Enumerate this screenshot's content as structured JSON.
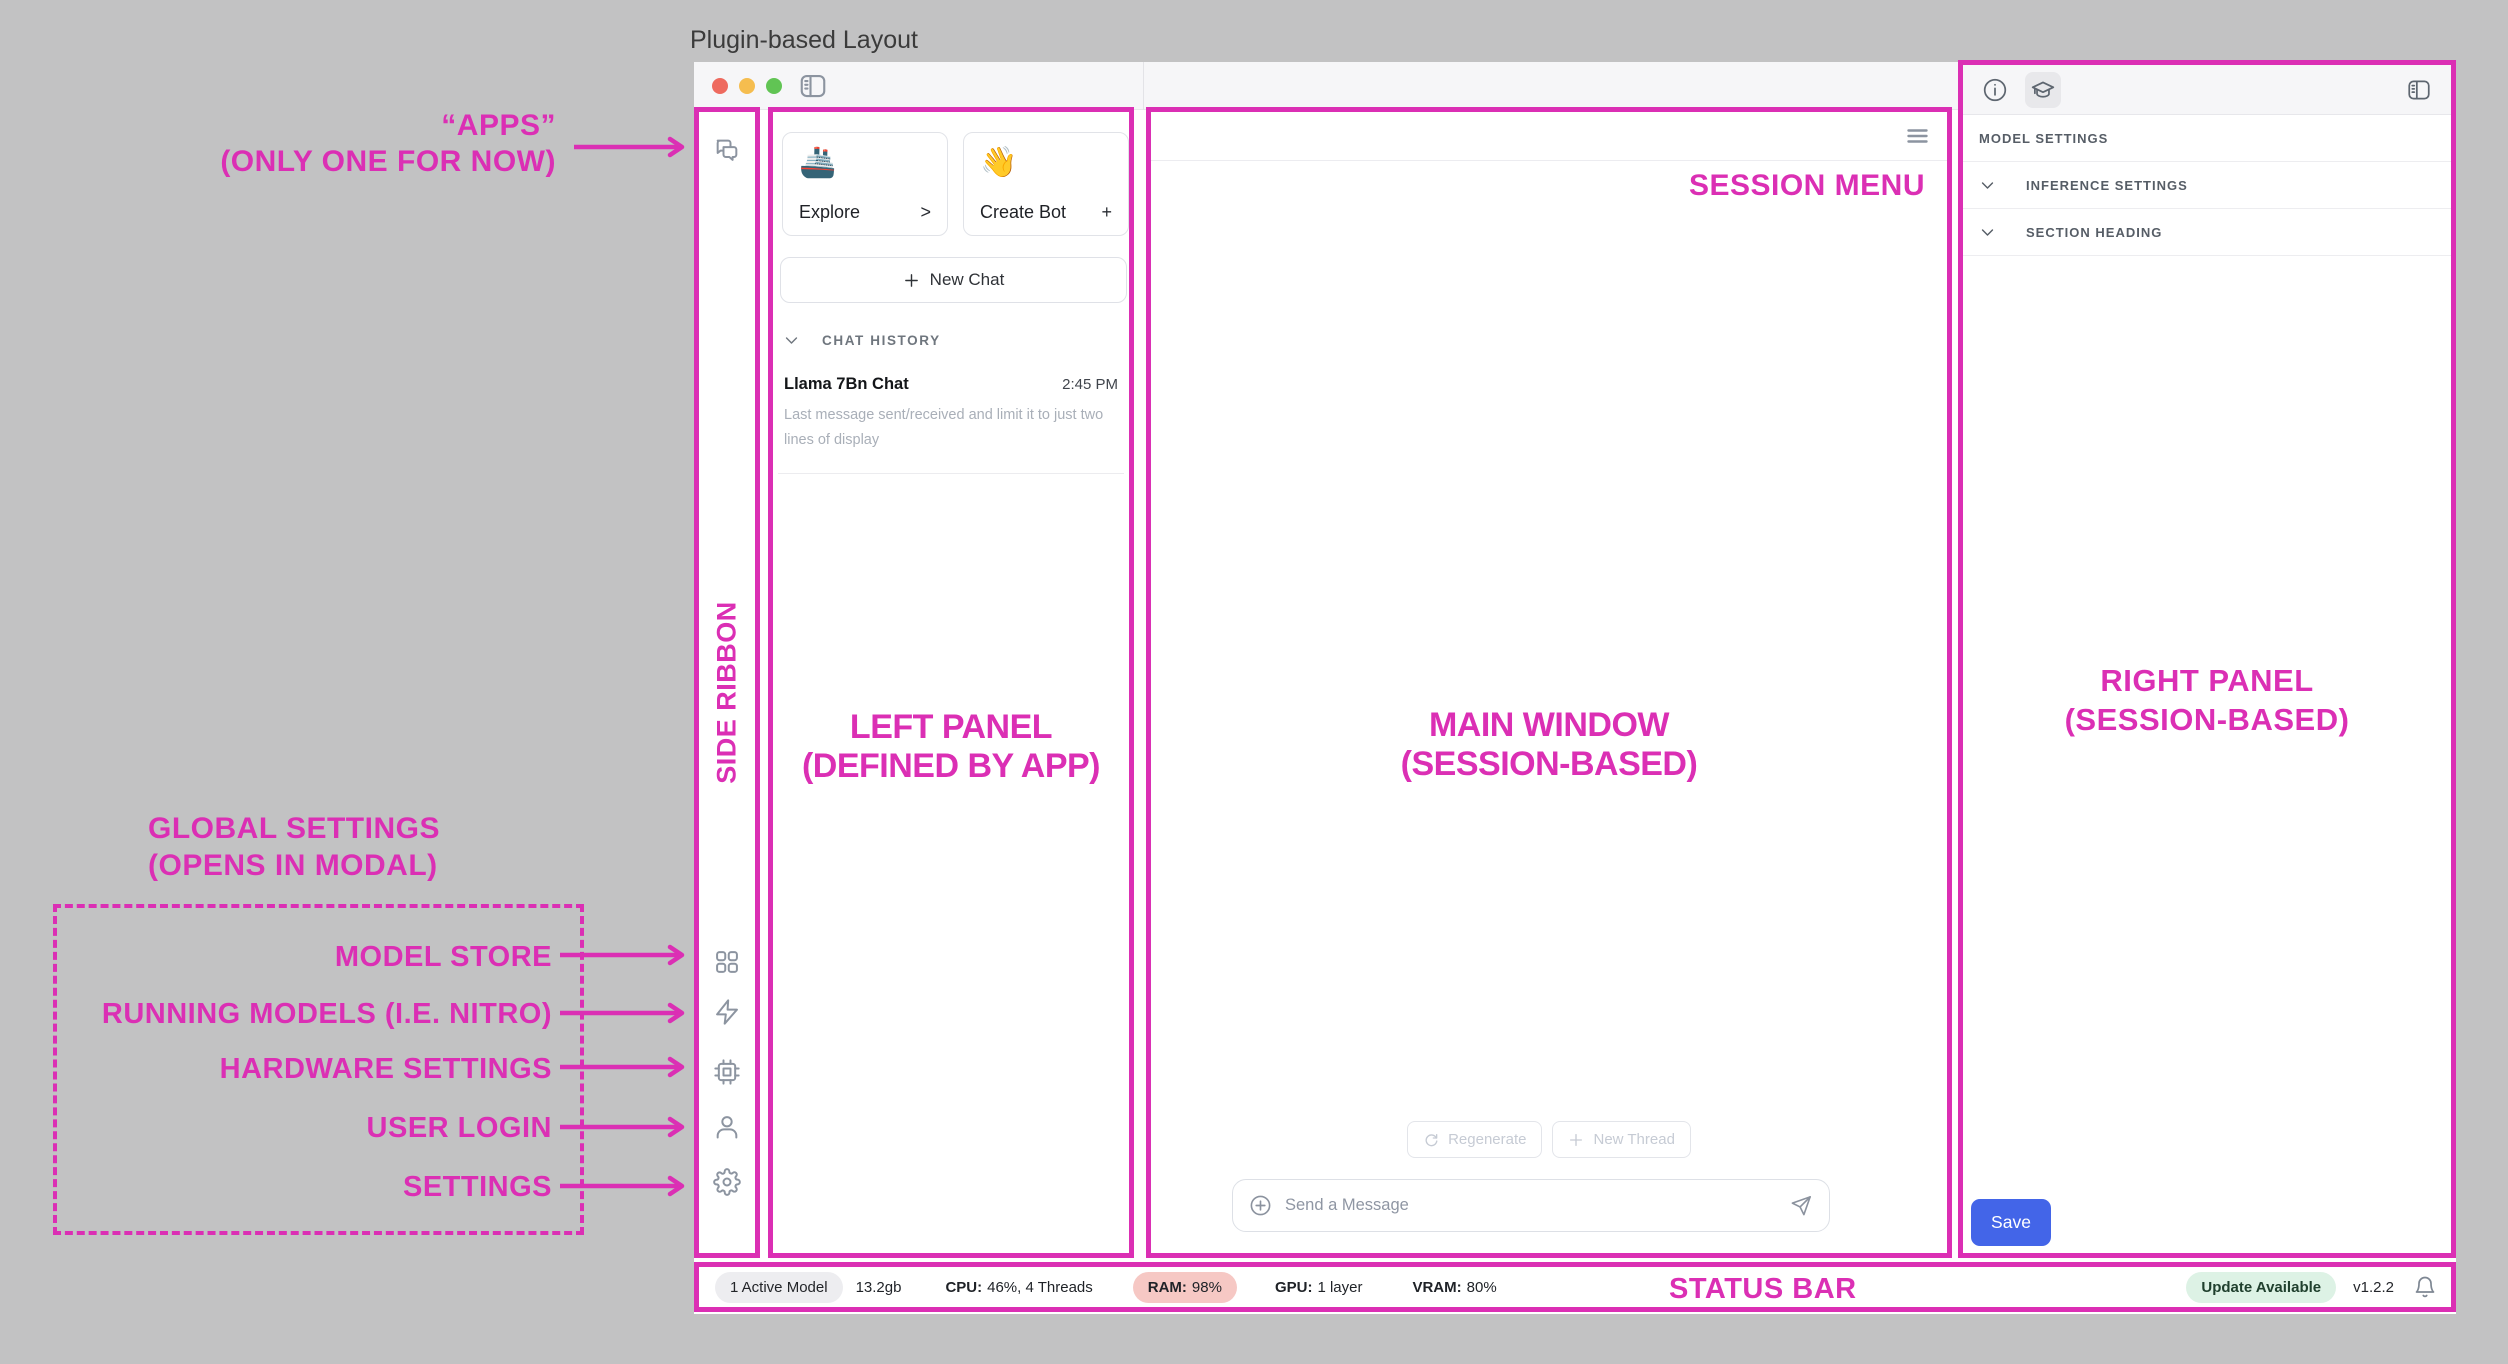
{
  "title": "Plugin-based Layout",
  "annotations": {
    "apps": {
      "line1": "“APPS”",
      "line2": "(ONLY ONE FOR NOW)"
    },
    "side_ribbon": "SIDE RIBBON",
    "left_panel": {
      "line1": "LEFT PANEL",
      "line2": "(DEFINED BY APP)"
    },
    "main_window": {
      "line1": "MAIN WINDOW",
      "line2": "(SESSION-BASED)"
    },
    "session_menu": "SESSION MENU",
    "right_panel": {
      "line1": "RIGHT PANEL",
      "line2": "(SESSION-BASED)"
    },
    "global_settings": {
      "line1": "GLOBAL SETTINGS",
      "line2": "(OPENS IN MODAL)"
    },
    "global_items": [
      "MODEL STORE",
      "RUNNING MODELS (I.E. NITRO)",
      "HARDWARE SETTINGS",
      "USER LOGIN",
      "SETTINGS"
    ],
    "status_bar": "STATUS BAR"
  },
  "left_panel": {
    "explore": {
      "emoji": "🚢",
      "label": "Explore",
      "affix": ">"
    },
    "create_bot": {
      "emoji": "👋",
      "label": "Create Bot",
      "affix": "+"
    },
    "new_chat_label": "New Chat",
    "chat_history_label": "CHAT HISTORY",
    "chat_item": {
      "title": "Llama 7Bn Chat",
      "time": "2:45 PM",
      "preview": "Last message sent/received and limit it to just two lines of display"
    }
  },
  "ribbon": {
    "wave_emoji": "👋"
  },
  "main_window": {
    "regenerate_label": "Regenerate",
    "new_thread_label": "New Thread",
    "message_placeholder": "Send a Message"
  },
  "right_panel": {
    "model_settings_label": "MODEL SETTINGS",
    "sections": [
      "INFERENCE SETTINGS",
      "SECTION HEADING"
    ],
    "save_label": "Save"
  },
  "status_bar": {
    "active_model": "1 Active Model",
    "memory": "13.2gb",
    "cpu_label": "CPU:",
    "cpu_value": "46%, 4 Threads",
    "ram_label": "RAM:",
    "ram_value": "98%",
    "gpu_label": "GPU:",
    "gpu_value": "1 layer",
    "vram_label": "VRAM:",
    "vram_value": "80%",
    "update_badge": "Update Available",
    "version": "v1.2.2"
  }
}
